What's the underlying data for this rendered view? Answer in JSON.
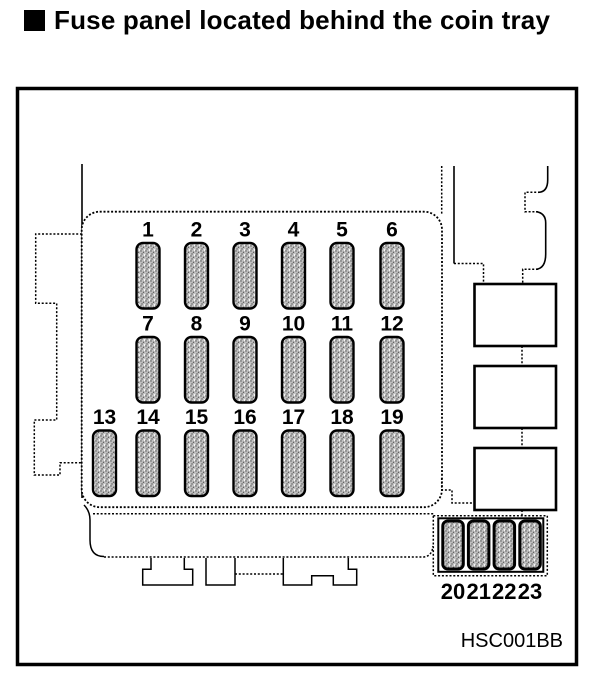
{
  "title": "Fuse panel located behind the coin tray",
  "figure_code": "HSC001BB",
  "fuse_panel": {
    "rows": [
      [
        "1",
        "2",
        "3",
        "4",
        "5",
        "6"
      ],
      [
        "7",
        "8",
        "9",
        "10",
        "11",
        "12"
      ],
      [
        "13",
        "14",
        "15",
        "16",
        "17",
        "18",
        "19"
      ]
    ],
    "sub_box": [
      "20",
      "21",
      "22",
      "23"
    ]
  },
  "colors": {
    "line": "#000000",
    "fuse_fill": "#c2c2c2",
    "fuse_dot": "#555555",
    "background": "#ffffff"
  }
}
